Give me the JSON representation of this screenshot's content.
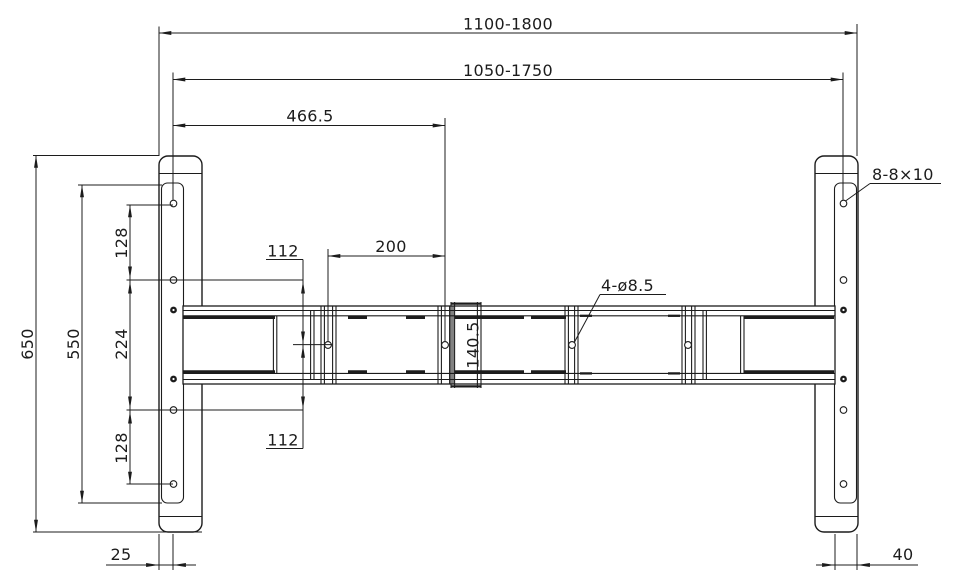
{
  "colors": {
    "line": "#1c1c1c",
    "background": "#ffffff"
  },
  "dimensions": {
    "overall_width": "1100-1800",
    "inner_span": "1050-1750",
    "beam_hole_offset": "466.5",
    "beam_hole_spacing": "200",
    "upper_center_offset": "112",
    "lower_center_offset": "112",
    "plate_pitch_upper": "128",
    "plate_pitch_middle": "224",
    "plate_pitch_lower": "128",
    "plate_hole_span": "550",
    "foot_length": "650",
    "beam_width": "140.5",
    "foot_offset_left": "25",
    "foot_offset_right": "40"
  },
  "callouts": {
    "beam_holes": "4-ø8.5",
    "foot_slots": "8-8×10"
  }
}
